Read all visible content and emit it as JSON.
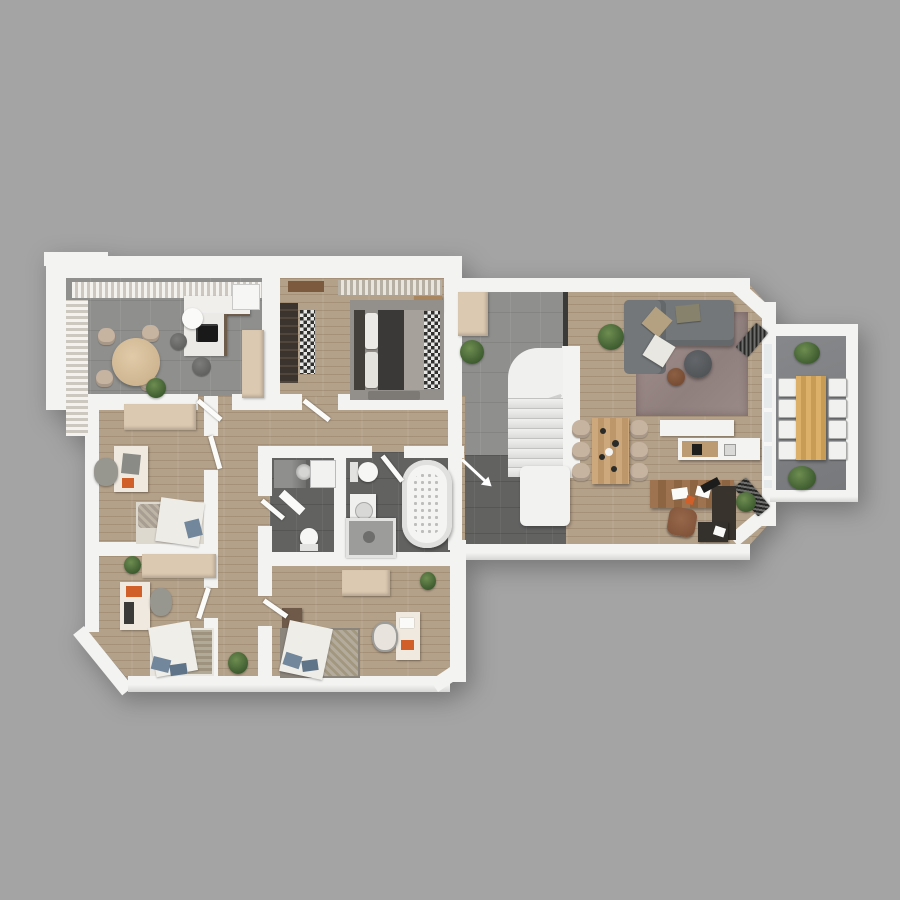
{
  "scene": {
    "title": "3D apartment floor plan - top-down render",
    "background": "#a4a4a4",
    "palette": {
      "background": "#a4a4a4",
      "wall": "#f3f3f1",
      "wall-shade": "#d9d9d7",
      "floor-wood": "#b4a189",
      "floor-tile": "#8f8f8d",
      "floor-tile-dark": "#626261",
      "floor-balcony": "#7e8083",
      "cabinet-beige": "#dbc9b1",
      "sofa-gray": "#73777a",
      "rug-mauve": "#9e8d8a",
      "wood-furniture": "#c9a478",
      "desk-wood": "#996e4a",
      "dark-wood": "#39332d",
      "accent-orange": "#d15f2a",
      "plant-green": "#4e6b3a",
      "pillow-blue": "#72879c",
      "outdoor-table-wood": "#d4a760"
    },
    "rooms": [
      {
        "id": "dining-kitchen",
        "name": "Dining / Kitchen",
        "floor": "gray tile",
        "furniture": [
          "round dining table",
          "4 beige chairs",
          "L-shaped kitchen counter",
          "black cooktop",
          "fridge",
          "tall beige cabinet",
          "2 dark bar stools",
          "white side table",
          "curtained windows",
          "plant"
        ]
      },
      {
        "id": "master-bedroom",
        "name": "Master Bedroom",
        "floor": "wood",
        "furniture": [
          "double bed with dark headboard",
          "dark slatted wardrobe",
          "black-white patterned runner rugs",
          "wood nightstand",
          "wall shelf",
          "curtains",
          "bench"
        ]
      },
      {
        "id": "hallway",
        "name": "Hallway with staircase",
        "floor": "gray tile",
        "furniture": [
          "beige sideboard",
          "plant",
          "winder staircase",
          "dark glass partition"
        ]
      },
      {
        "id": "entry",
        "name": "Entry",
        "floor": "dark tile",
        "furniture": [
          "white closet",
          "entrance arrow"
        ]
      },
      {
        "id": "living-room",
        "name": "Living / Dining / Home office",
        "floor": "wood",
        "furniture": [
          "gray sectional sofa",
          "cushions",
          "mauve rug",
          "round coffee table",
          "round side table",
          "plants",
          "wood dining table",
          "6 beige chairs",
          "kitchen island with cooktop",
          "white counter",
          "wood desk with dark return",
          "leather desk chair",
          "dark cabinet",
          "2 radiators"
        ]
      },
      {
        "id": "balcony",
        "name": "Balcony",
        "floor": "concrete",
        "furniture": [
          "long wood outdoor table",
          "8 white chairs",
          "2 plants"
        ]
      },
      {
        "id": "bedroom-left",
        "name": "Bedroom / Office (left)",
        "floor": "wood",
        "furniture": [
          "beige wardrobe",
          "desk",
          "gray chair",
          "orange laptop",
          "single bed with blue pillow"
        ]
      },
      {
        "id": "bedroom-bottom-left",
        "name": "Bedroom (bottom left)",
        "floor": "wood",
        "furniture": [
          "beige wardrobe",
          "desk with orange laptop",
          "gray chair",
          "single bed with blue pillows",
          "plant"
        ]
      },
      {
        "id": "bedroom-bottom-middle",
        "name": "Bedroom (bottom middle)",
        "floor": "wood",
        "furniture": [
          "beige wardrobe",
          "dark nightstand",
          "bed with patterned blanket and blue pillows",
          "white desk with orange laptop",
          "chair",
          "plant"
        ]
      },
      {
        "id": "wc",
        "name": "WC / Laundry",
        "floor": "dark tile",
        "furniture": [
          "gray cabinet",
          "round sink",
          "washing machine",
          "toilet",
          "towel"
        ]
      },
      {
        "id": "bathroom",
        "name": "Bathroom",
        "floor": "dark tile",
        "furniture": [
          "toilet",
          "vanity sink",
          "glass shower",
          "jacuzzi bathtub"
        ]
      },
      {
        "id": "corridor",
        "name": "Corridor",
        "floor": "wood",
        "furniture": [
          "7 open door leaves",
          "plant"
        ]
      }
    ],
    "staircase": {
      "treads": 8,
      "winder_steps": 3,
      "shape": "L-winder"
    }
  }
}
